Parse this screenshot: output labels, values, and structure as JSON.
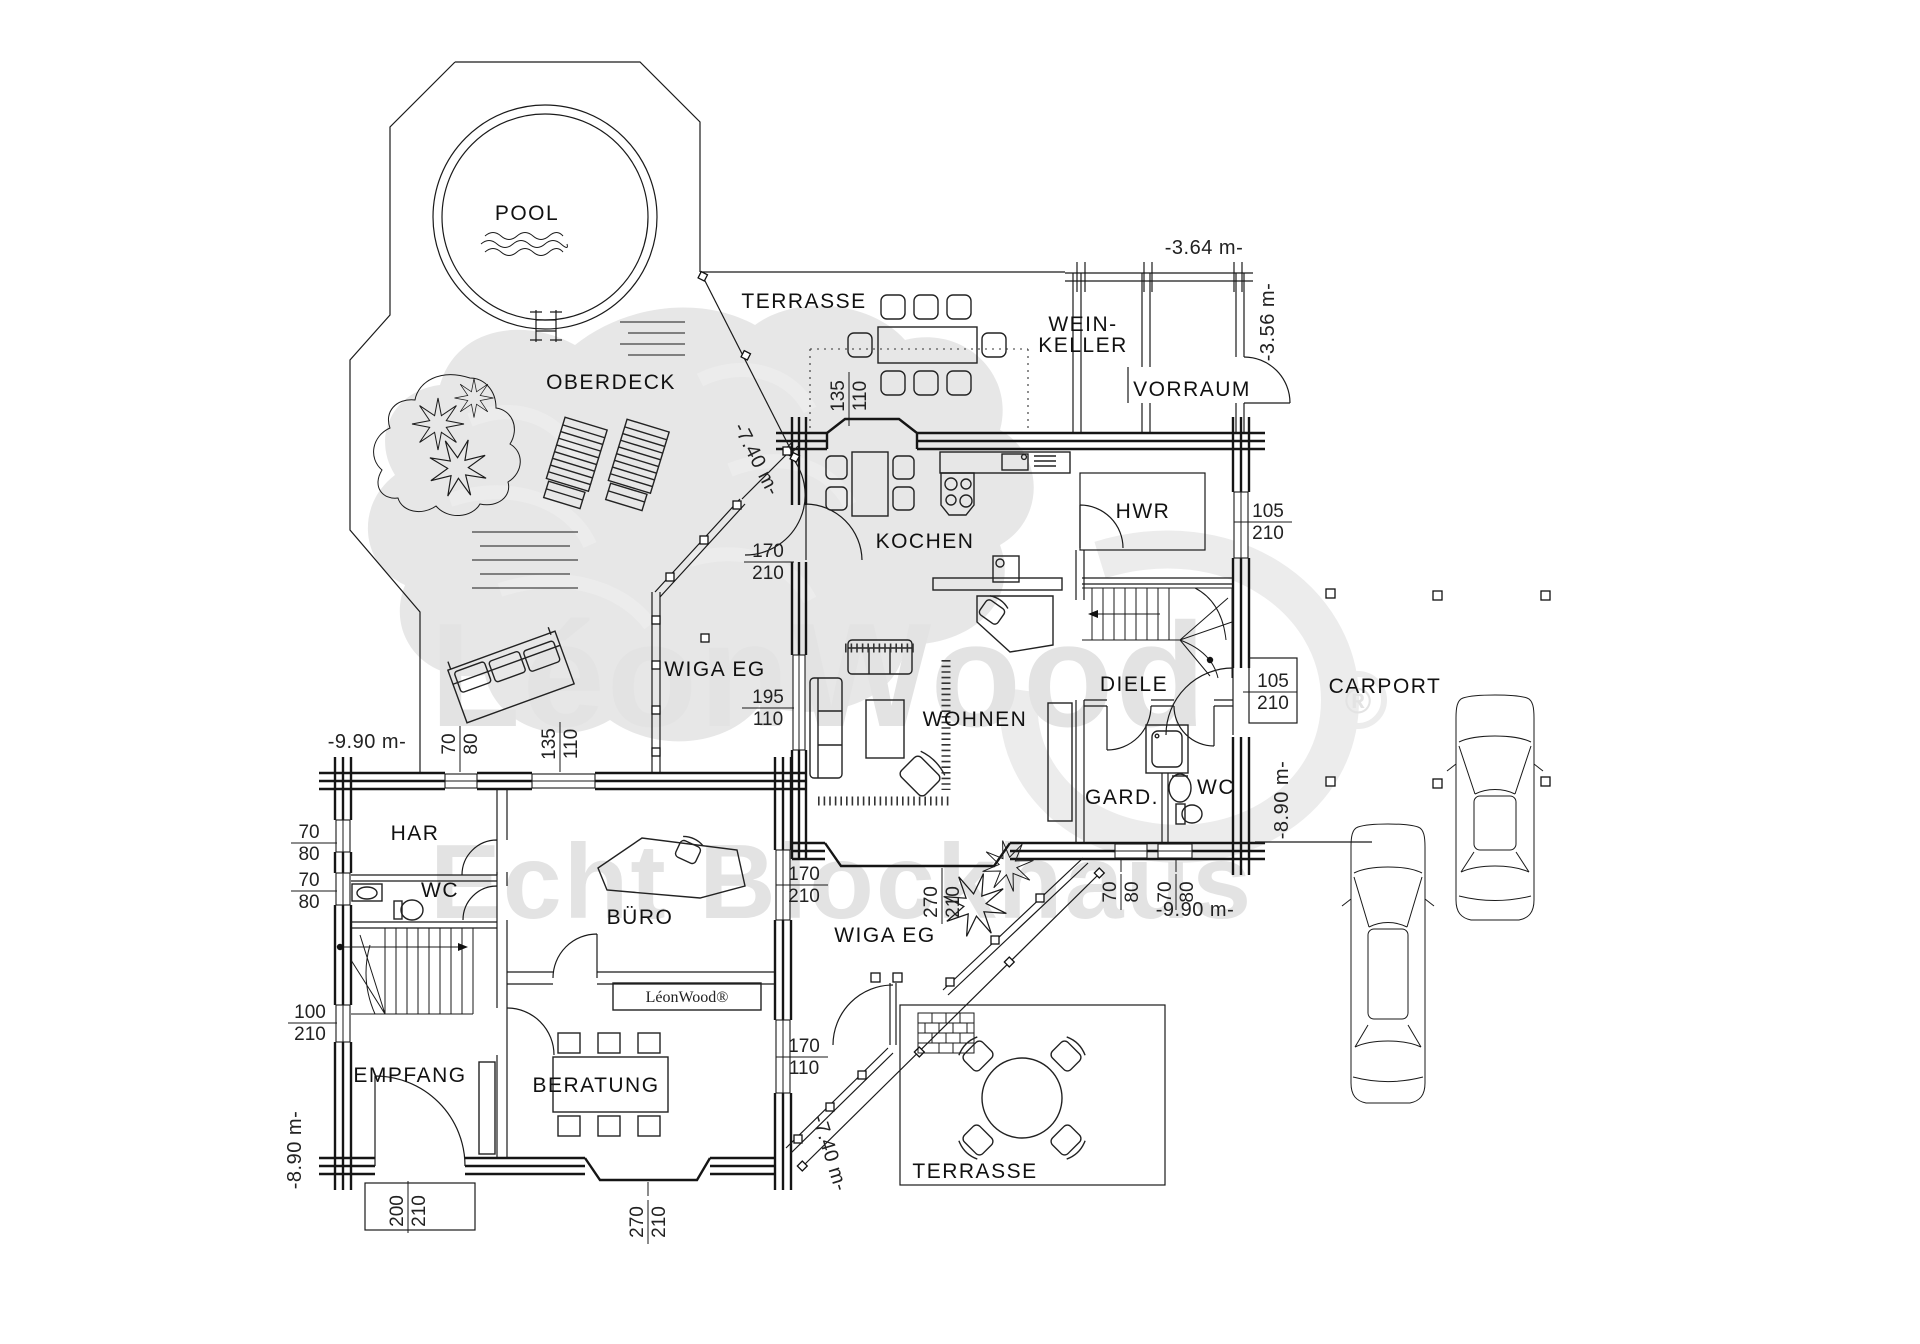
{
  "watermark": {
    "brand": "LéonWood",
    "registered": "®",
    "tagline": "Echt Blockhaus"
  },
  "plan_brand_label": "LéonWood®",
  "rooms": {
    "pool": "POOL",
    "oberdeck": "OBERDECK",
    "terrasse_top": "TERRASSE",
    "weinkeller_l1": "WEIN-",
    "weinkeller_l2": "KELLER",
    "vorraum": "VORRAUM",
    "kochen": "KOCHEN",
    "hwr": "HWR",
    "diele": "DIELE",
    "wohnen": "WOHNEN",
    "gard": "GARD.",
    "wc_main": "WC",
    "wiga_upper": "WIGA EG",
    "wiga_lower": "WIGA EG",
    "terrasse_bottom": "TERRASSE",
    "carport": "CARPORT",
    "har": "HAR",
    "wc_left": "WC",
    "buero": "BÜRO",
    "empfang": "EMPFANG",
    "beratung": "BERATUNG"
  },
  "overall_dims": {
    "top_width": "-3.64 m-",
    "top_height": "-3.56 m-",
    "diag_upper": "-7.40 m-",
    "diag_lower": "-7.40 m-",
    "left_width": "-9.90 m-",
    "bottom_width": "-9.90 m-",
    "right_height": "-8.90 m-",
    "left_height": "-8.90 m-"
  },
  "opening_dims": [
    {
      "w": "135",
      "h": "110"
    },
    {
      "w": "170",
      "h": "210"
    },
    {
      "w": "195",
      "h": "110"
    },
    {
      "w": "105",
      "h": "210"
    },
    {
      "w": "105",
      "h": "210"
    },
    {
      "w": "70",
      "h": "80"
    },
    {
      "w": "70",
      "h": "80"
    },
    {
      "w": "270",
      "h": "210"
    },
    {
      "w": "70",
      "h": "80"
    },
    {
      "w": "135",
      "h": "110"
    },
    {
      "w": "70",
      "h": "80"
    },
    {
      "w": "70",
      "h": "80"
    },
    {
      "w": "100",
      "h": "210"
    },
    {
      "w": "200",
      "h": "210"
    },
    {
      "w": "270",
      "h": "210"
    },
    {
      "w": "170",
      "h": "210"
    },
    {
      "w": "170",
      "h": "110"
    }
  ]
}
